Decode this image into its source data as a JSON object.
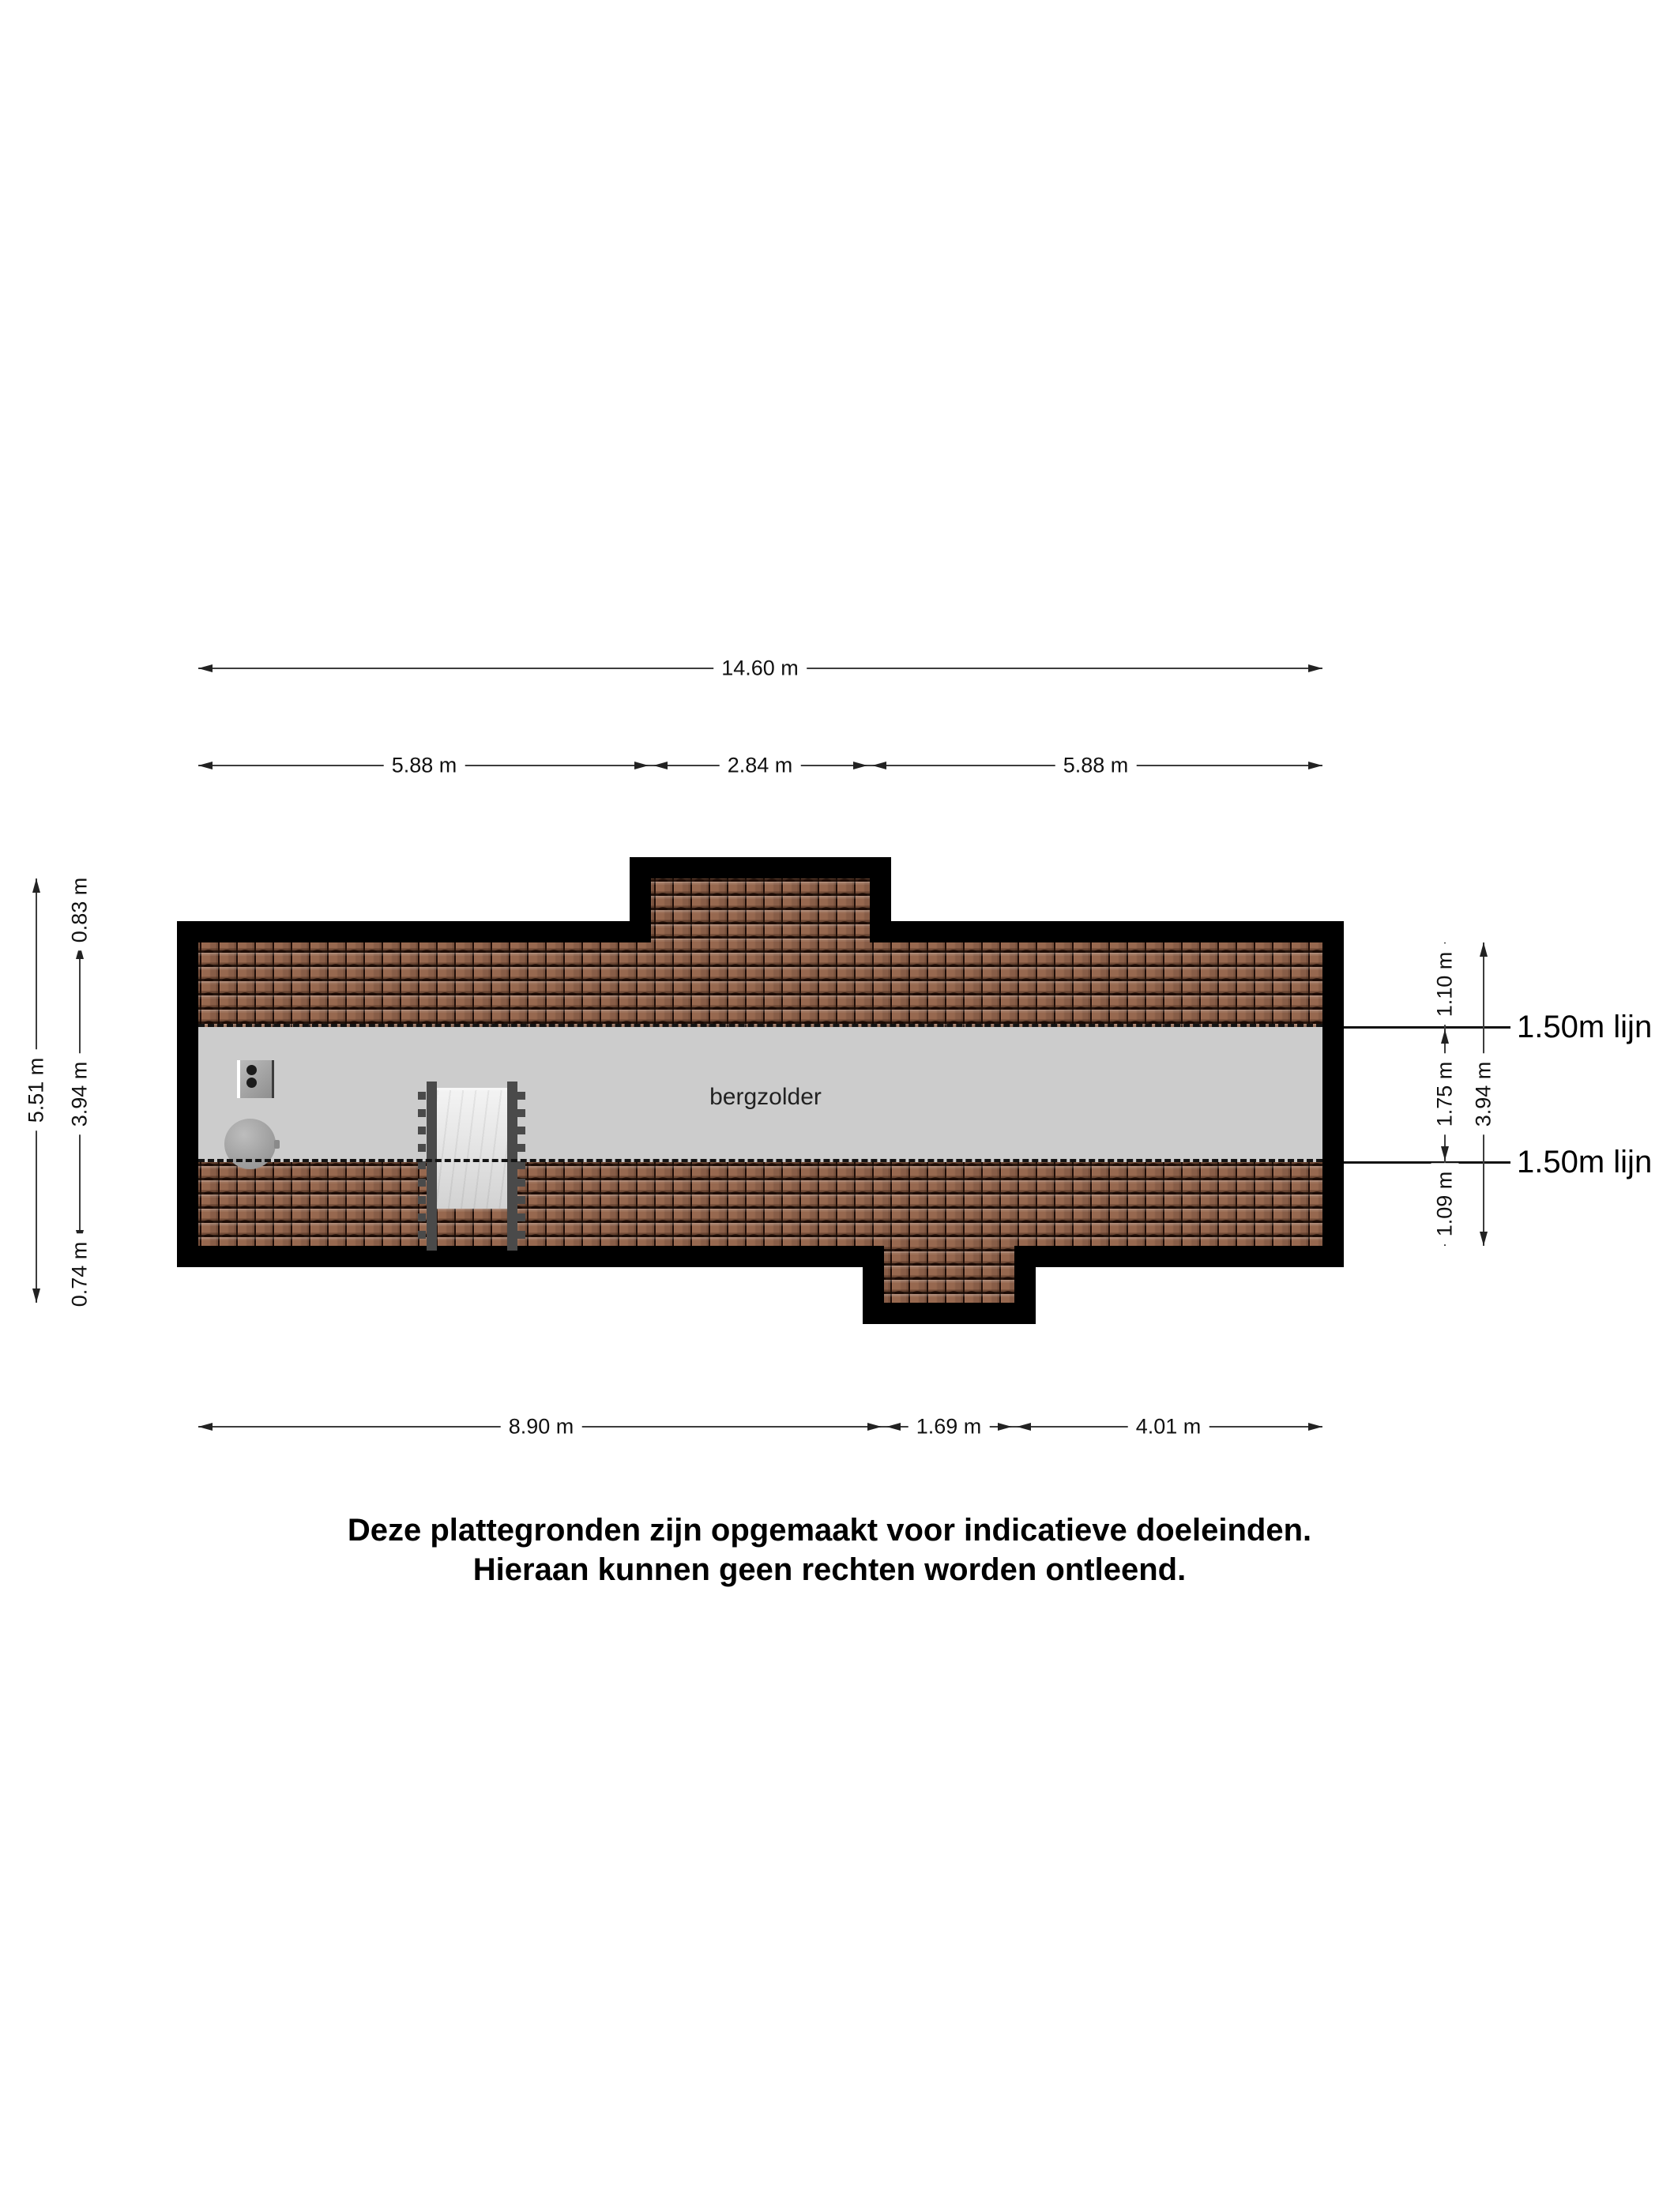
{
  "plan": {
    "room_label": "bergzolder",
    "dims": {
      "top_total": "14.60 m",
      "top_seg1": "5.88 m",
      "top_seg2": "2.84 m",
      "top_seg3": "5.88 m",
      "bottom_seg1": "8.90 m",
      "bottom_seg2": "1.69 m",
      "bottom_seg3": "4.01 m",
      "left_total": "5.51 m",
      "left_seg1": "0.83 m",
      "left_seg2": "3.94 m",
      "left_seg3": "0.74 m",
      "right_seg1": "1.10 m",
      "right_seg2": "1.75 m",
      "right_seg3": "1.09 m",
      "right_total": "3.94 m",
      "height_line_top": "1.50m lijn",
      "height_line_bottom": "1.50m lijn"
    },
    "disclaimer": {
      "line1": "Deze plattegronden zijn opgemaakt voor indicatieve doeleinden.",
      "line2": "Hieraan kunnen geen rechten worden ontleend."
    },
    "colors": {
      "wall": "#000000",
      "tile": "#97684f",
      "floor": "#cccccc",
      "dim": "#3d3d3d"
    }
  }
}
